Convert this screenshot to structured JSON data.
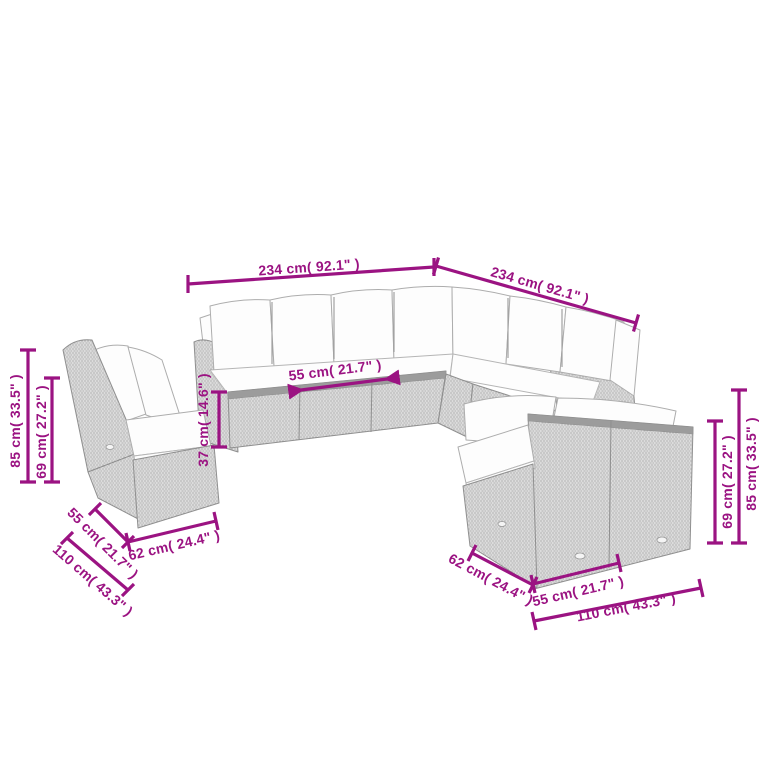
{
  "diagram": {
    "type": "product-dimension-diagram",
    "subject": "rattan-garden-corner-lounge-set-line-art",
    "accent_color": "#9B1382",
    "rattan_color": "#dcdcdc",
    "outline_color": "#8f8f8f",
    "cushion_color": "#fdfdfd",
    "dimensions": {
      "main_width_left": "234 cm( 92.1\" )",
      "main_width_right": "234 cm( 92.1\" )",
      "seat_module_width": "55 cm( 21.7\" )",
      "left_total_height": "85 cm( 33.5\" )",
      "left_backrest_height": "69 cm( 27.2\" )",
      "seat_base_height": "37 cm( 14.6\" )",
      "left_seat_depth": "55 cm( 21.7\" )",
      "left_module_width": "62 cm( 24.4\" )",
      "left_bench_width": "110 cm( 43.3\" )",
      "right_seat_depth": "62 cm( 24.4\" )",
      "right_module_width": "55 cm( 21.7\" )",
      "right_bench_width": "110 cm( 43.3\" )",
      "right_backrest_height": "69 cm( 27.2\" )",
      "right_total_height": "85 cm( 33.5\" )"
    }
  }
}
